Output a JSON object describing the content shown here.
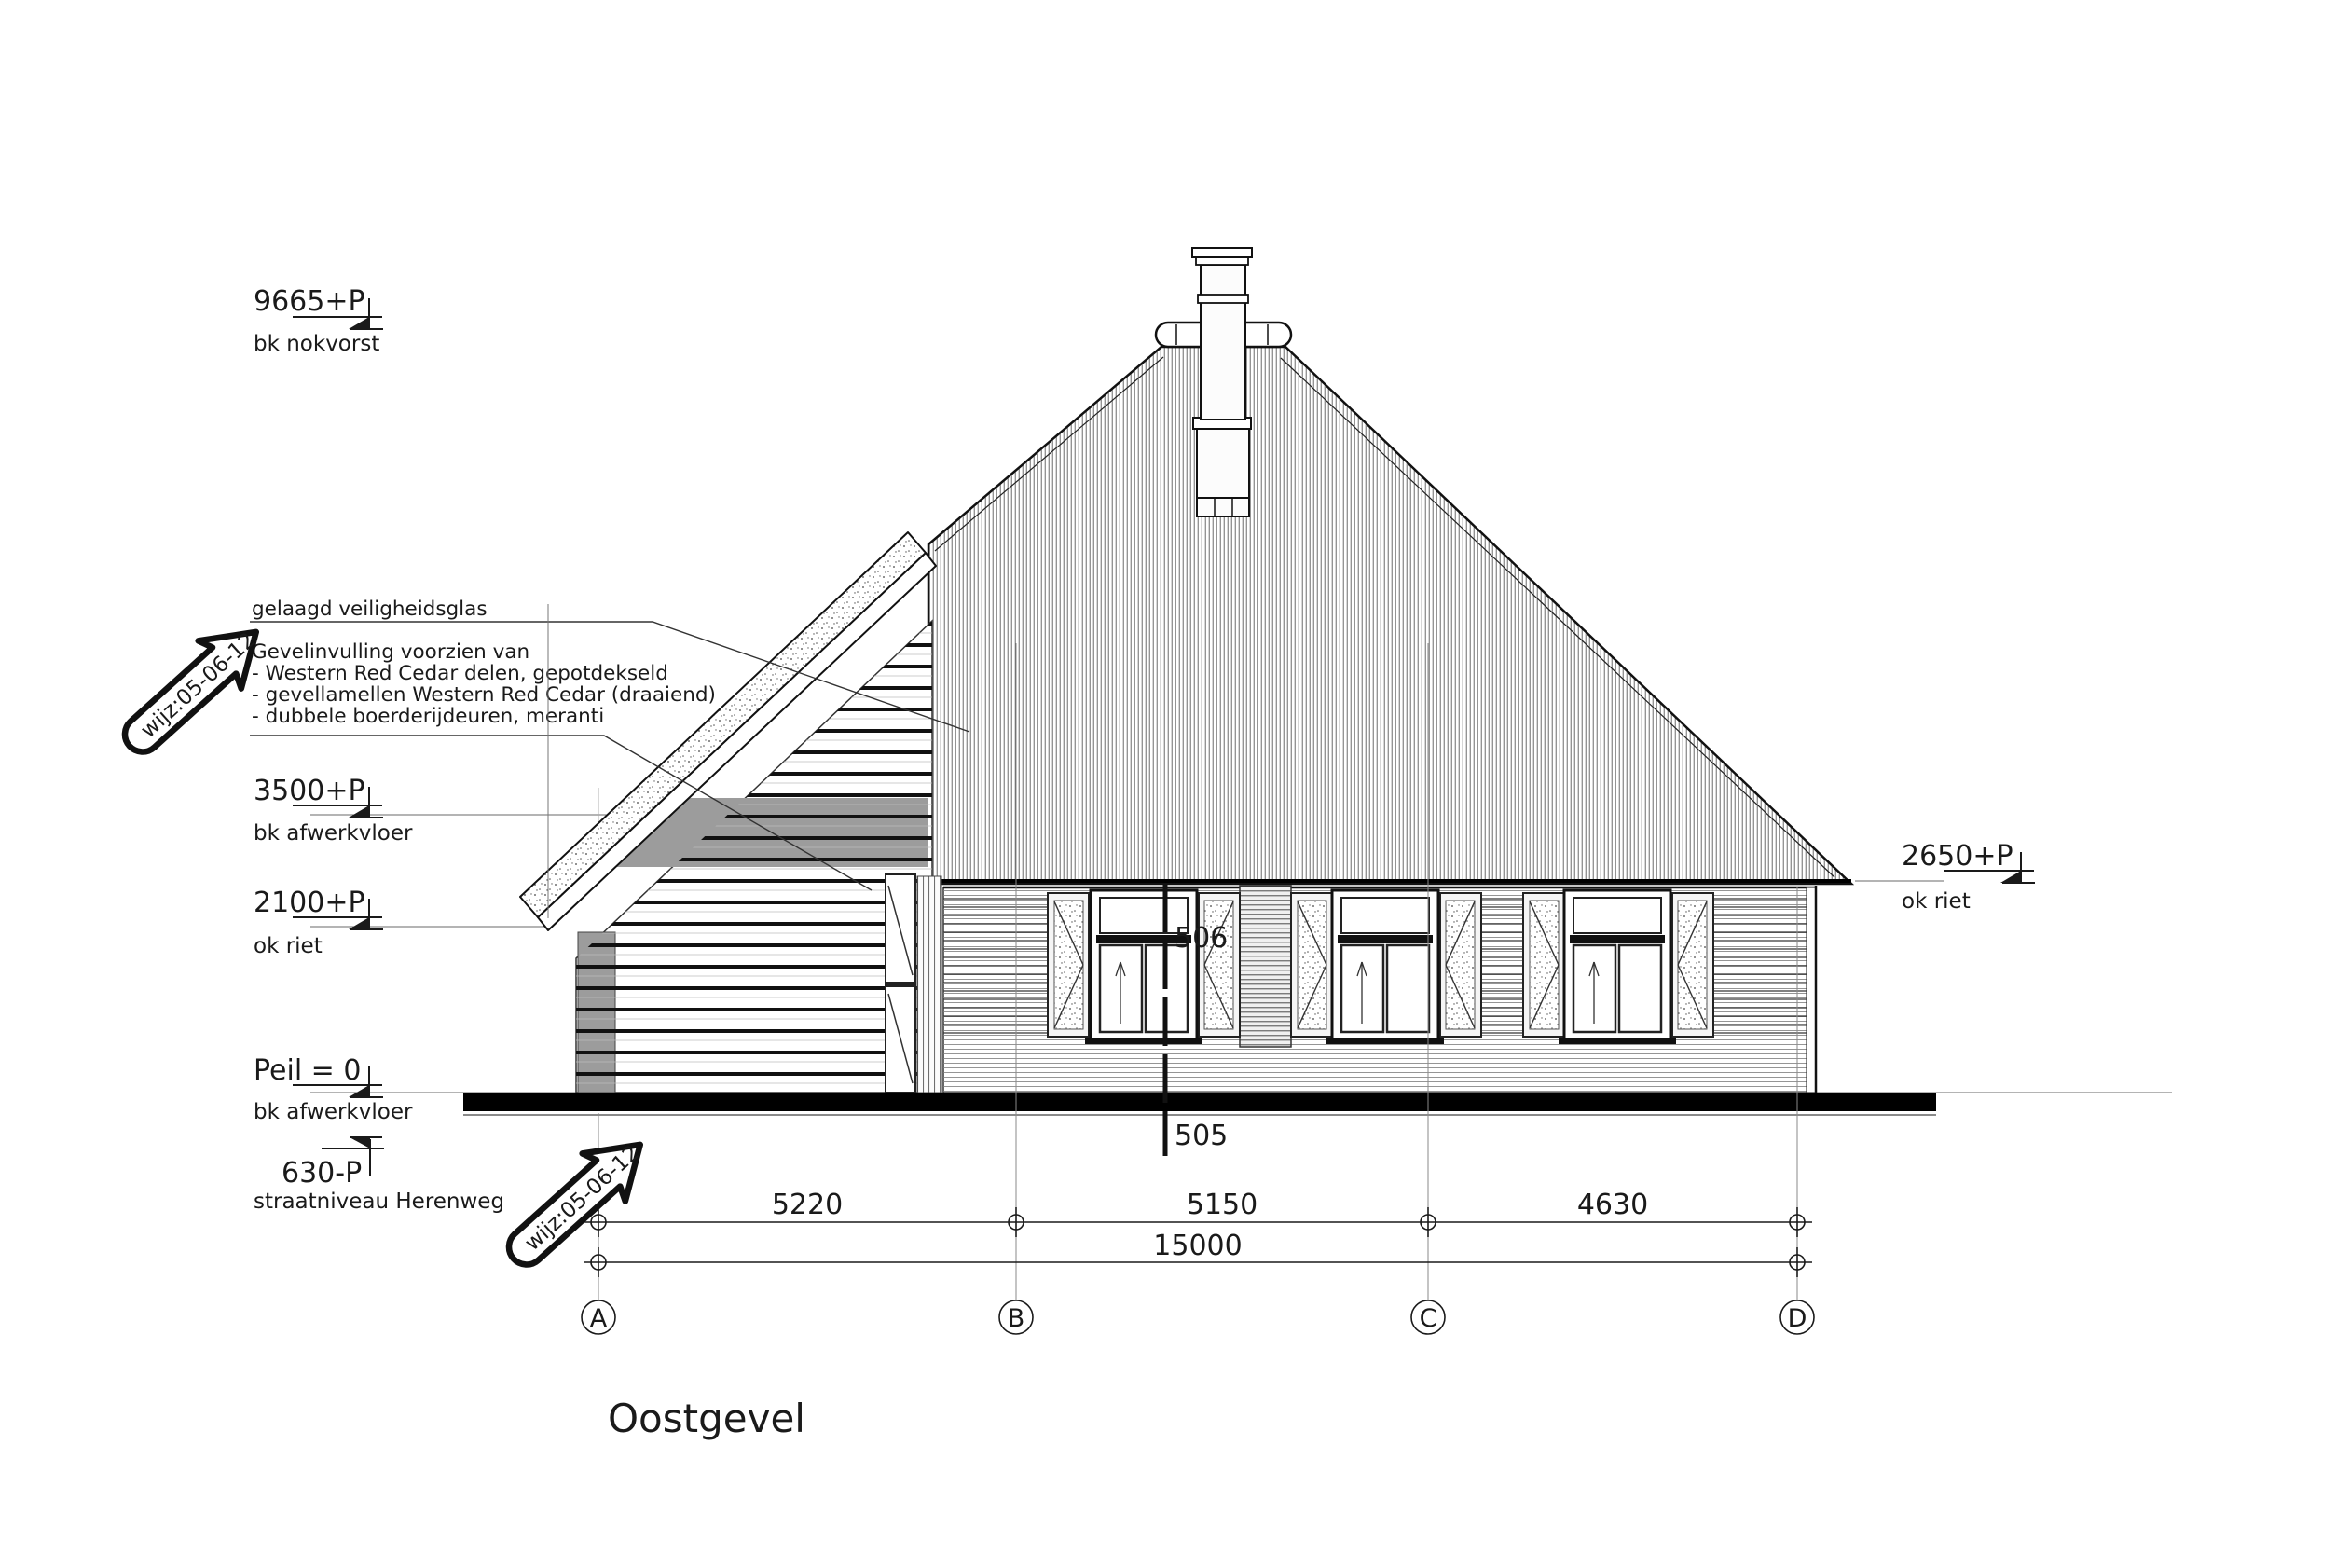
{
  "drawing": {
    "title": "Oostgevel",
    "revision_label": "wijz:05-06-12",
    "levels": {
      "nokvorst": {
        "value": "9665+P",
        "label": "bk nokvorst"
      },
      "afwerkvloer1e": {
        "value": "3500+P",
        "label": "bk afwerkvloer"
      },
      "ok_riet_links": {
        "value": "2100+P",
        "label": "ok riet"
      },
      "peil": {
        "value": "Peil = 0",
        "label": "bk afwerkvloer"
      },
      "straat": {
        "value": "630-P",
        "label": "straatniveau Herenweg"
      },
      "ok_riet_rechts": {
        "value": "2650+P",
        "label": "ok riet"
      }
    },
    "annotations": {
      "glass": "gelaagd veiligheidsglas",
      "facade": [
        "Gevelinvulling voorzien van",
        "- Western Red Cedar delen, gepotdekseld",
        "- gevellamellen Western Red Cedar (draaiend)",
        "- dubbele boerderijdeuren, meranti"
      ]
    },
    "section_markers": {
      "top": "506",
      "bottom": "505"
    },
    "grid_labels": [
      "A",
      "B",
      "C",
      "D"
    ],
    "dimensions": {
      "segments": [
        "5220",
        "5150",
        "4630"
      ],
      "total": "15000"
    },
    "colors": {
      "line": "#1a1a1a",
      "gray_fill": "#9c9c9c",
      "background": "#ffffff"
    }
  }
}
